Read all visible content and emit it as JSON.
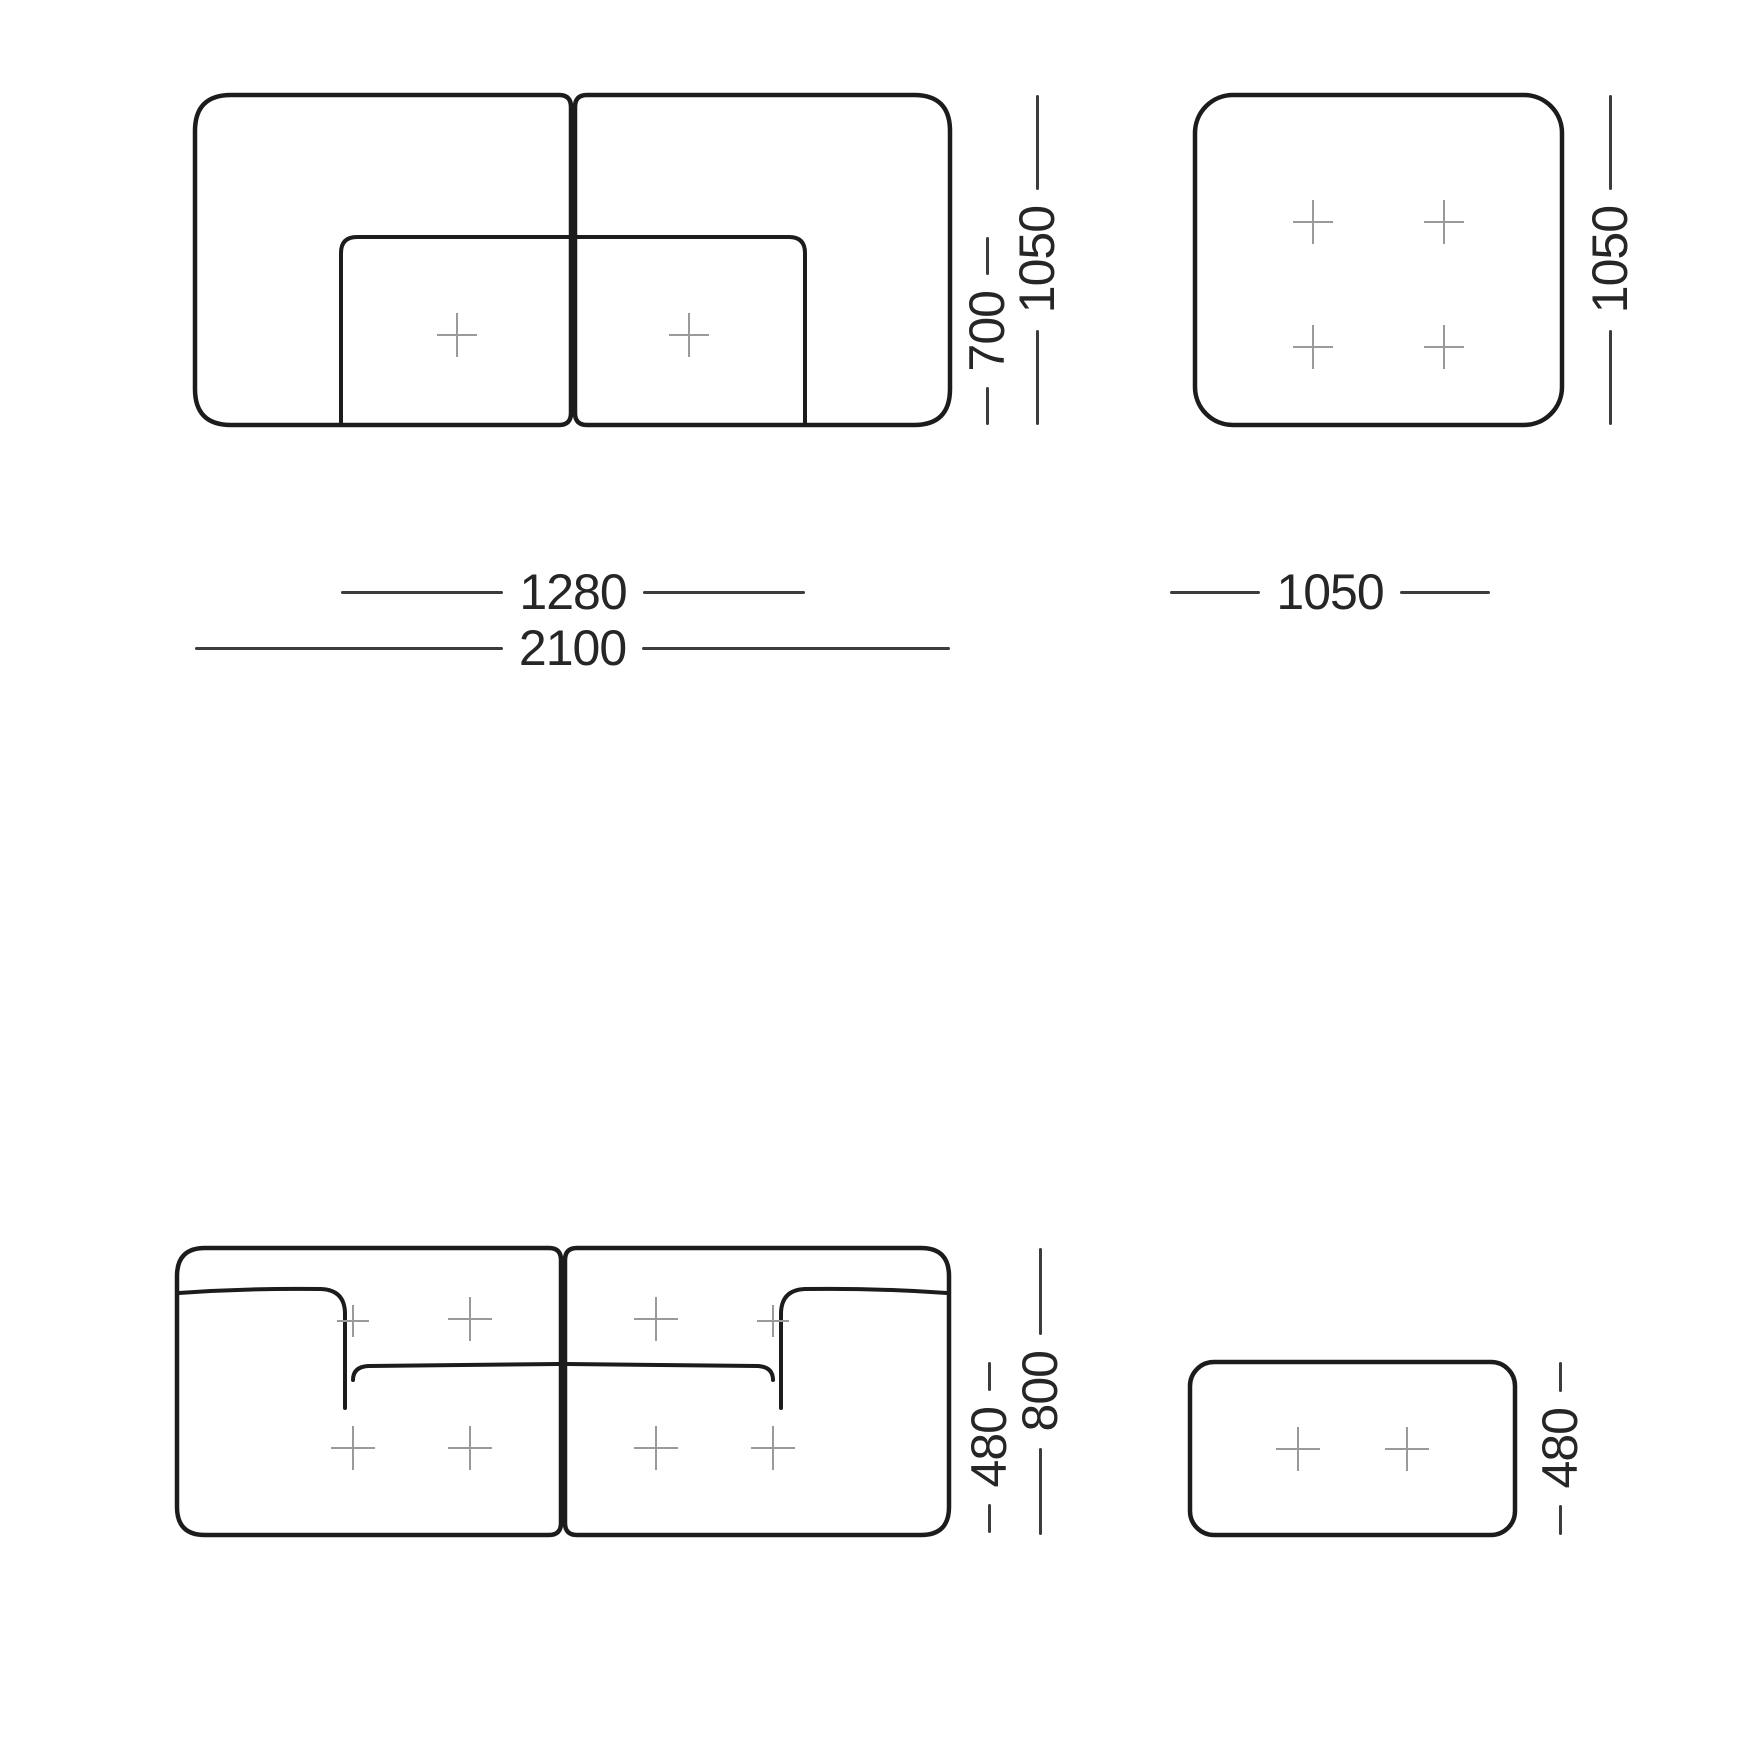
{
  "colors": {
    "background": "#ffffff",
    "outline": "#1c1c1c",
    "dimension_line": "#3c3c3c",
    "dimension_text": "#262626",
    "tuft_cross": "#9a9a9a"
  },
  "views": {
    "sofa_plan": {
      "seat_width": "1280",
      "total_width": "2100",
      "seat_depth": "700",
      "total_depth": "1050"
    },
    "ottoman_plan": {
      "width": "1050",
      "depth": "1050"
    },
    "sofa_front": {
      "seat_height": "480",
      "total_height": "800"
    },
    "ottoman_front": {
      "height": "480"
    }
  }
}
